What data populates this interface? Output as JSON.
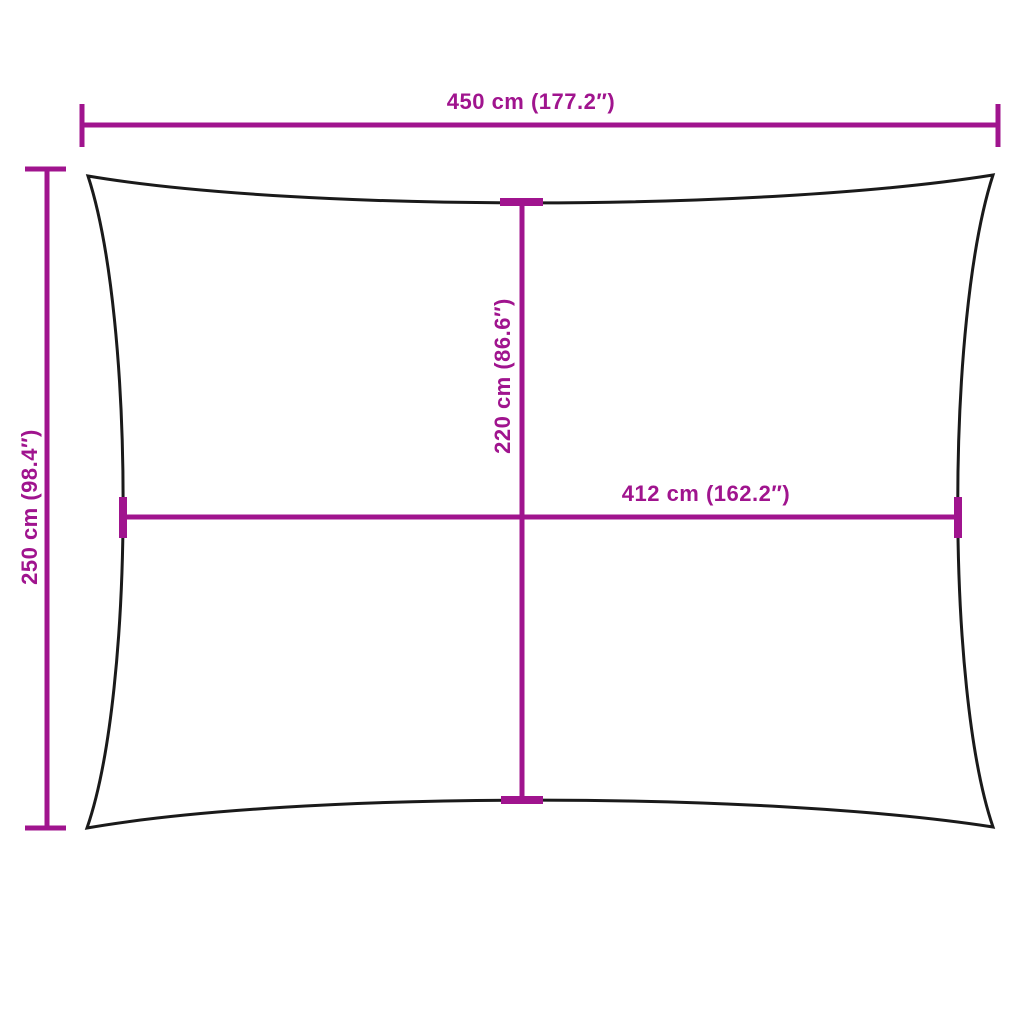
{
  "diagram": {
    "subject": "rectangular-shade-sail-dimension-drawing",
    "colors": {
      "background": "#FFFFFF",
      "sail_outline": "#1A1A1A",
      "dimension_lines": "#A0148E"
    },
    "labels": {
      "top_width": "450 cm (177.2″)",
      "left_height": "250 cm (98.4″)",
      "center_height": "220 cm (86.6″)",
      "center_width": "412 cm (162.2″)"
    }
  }
}
